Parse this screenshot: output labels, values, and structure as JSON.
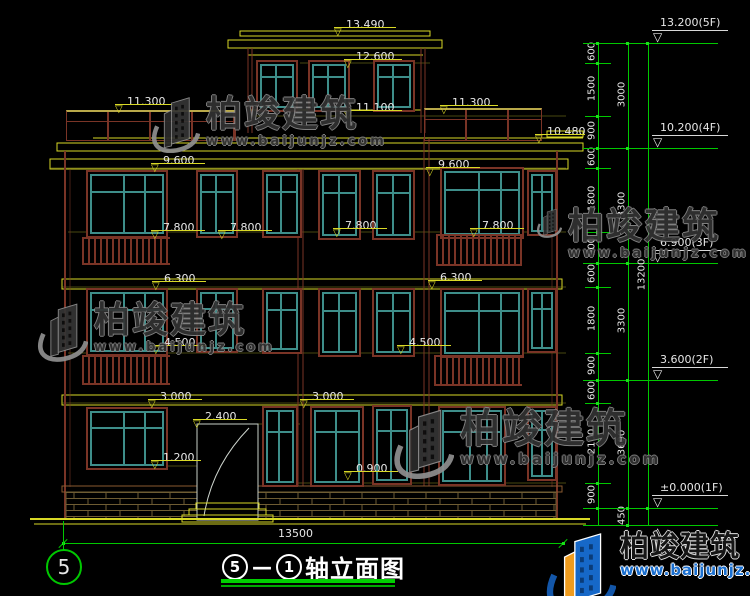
{
  "meta": {
    "type": "CAD building elevation drawing"
  },
  "title": {
    "bubble_left": "5",
    "separator": "—",
    "bubble_right": "1",
    "label": "轴立面图"
  },
  "axis_bubble": "5",
  "brand": {
    "name": "柏竣建筑",
    "url": "www.baijunjz.com"
  },
  "colors": {
    "line_yellow": "#d9d926",
    "dim_green": "#00c800",
    "wall_maroon": "#7a3426",
    "frame_teal": "#3e8e8a",
    "text_white": "#e6e6e6",
    "logo_blue": "#1668c8",
    "logo_orange": "#f09c1e"
  },
  "drawing": {
    "width_dim": {
      "text": "13500"
    },
    "flags": [
      {
        "t": "13.490",
        "x": 346,
        "y": 13,
        "w": 62
      },
      {
        "t": "12.600",
        "x": 356,
        "y": 45,
        "w": 58
      },
      {
        "t": "11.300",
        "x": 127,
        "y": 90,
        "w": 58
      },
      {
        "t": "11.300",
        "x": 452,
        "y": 91,
        "w": 58
      },
      {
        "t": "11.100",
        "x": 356,
        "y": 96,
        "w": 58
      },
      {
        "t": "10.480",
        "x": 547,
        "y": 120,
        "w": 50
      },
      {
        "t": "9.600",
        "x": 163,
        "y": 149,
        "w": 54
      },
      {
        "t": "9.600",
        "x": 438,
        "y": 153,
        "w": 54
      },
      {
        "t": "7.800",
        "x": 163,
        "y": 216,
        "w": 54
      },
      {
        "t": "7.800",
        "x": 230,
        "y": 216,
        "w": 54
      },
      {
        "t": "7.800",
        "x": 345,
        "y": 214,
        "w": 54
      },
      {
        "t": "7.800",
        "x": 482,
        "y": 214,
        "w": 54
      },
      {
        "t": "6.300",
        "x": 164,
        "y": 267,
        "w": 54
      },
      {
        "t": "6.300",
        "x": 440,
        "y": 266,
        "w": 54
      },
      {
        "t": "4.500",
        "x": 164,
        "y": 331,
        "w": 54
      },
      {
        "t": "4.500",
        "x": 409,
        "y": 331,
        "w": 54
      },
      {
        "t": "3.000",
        "x": 160,
        "y": 385,
        "w": 54
      },
      {
        "t": "3.000",
        "x": 312,
        "y": 385,
        "w": 54
      },
      {
        "t": "2.400",
        "x": 205,
        "y": 405,
        "w": 54
      },
      {
        "t": "1.200",
        "x": 163,
        "y": 446,
        "w": 50
      },
      {
        "t": "0.900",
        "x": 356,
        "y": 457,
        "w": 54
      }
    ],
    "floor_markers": [
      {
        "label": "13.200(5F)",
        "y": 43
      },
      {
        "label": "10.200(4F)",
        "y": 148
      },
      {
        "label": "6.900(3F)",
        "y": 263
      },
      {
        "label": "3.600(2F)",
        "y": 380
      },
      {
        "label": "±0.000(1F)",
        "y": 508
      },
      {
        "label": "",
        "y": 525
      }
    ],
    "chains": [
      {
        "x": 598,
        "segs": [
          {
            "t": "600",
            "a": 43,
            "b": 63
          },
          {
            "t": "1500",
            "a": 63,
            "b": 116
          },
          {
            "t": "900",
            "a": 116,
            "b": 148
          },
          {
            "t": "600",
            "a": 148,
            "b": 168
          },
          {
            "t": "1800",
            "a": 168,
            "b": 232
          },
          {
            "t": "900",
            "a": 232,
            "b": 263
          },
          {
            "t": "600",
            "a": 263,
            "b": 287
          },
          {
            "t": "1800",
            "a": 287,
            "b": 353
          },
          {
            "t": "900",
            "a": 353,
            "b": 380
          },
          {
            "t": "600",
            "a": 380,
            "b": 403
          },
          {
            "t": "2100",
            "a": 403,
            "b": 483
          },
          {
            "t": "900",
            "a": 483,
            "b": 508
          }
        ]
      },
      {
        "x": 628,
        "segs": [
          {
            "t": "3000",
            "a": 43,
            "b": 148
          },
          {
            "t": "3300",
            "a": 148,
            "b": 263
          },
          {
            "t": "3300",
            "a": 263,
            "b": 380
          },
          {
            "t": "3600",
            "a": 380,
            "b": 508
          },
          {
            "t": "450",
            "a": 508,
            "b": 525
          }
        ]
      },
      {
        "x": 648,
        "segs": [
          {
            "t": "13200",
            "a": 43,
            "b": 508
          }
        ]
      }
    ]
  }
}
